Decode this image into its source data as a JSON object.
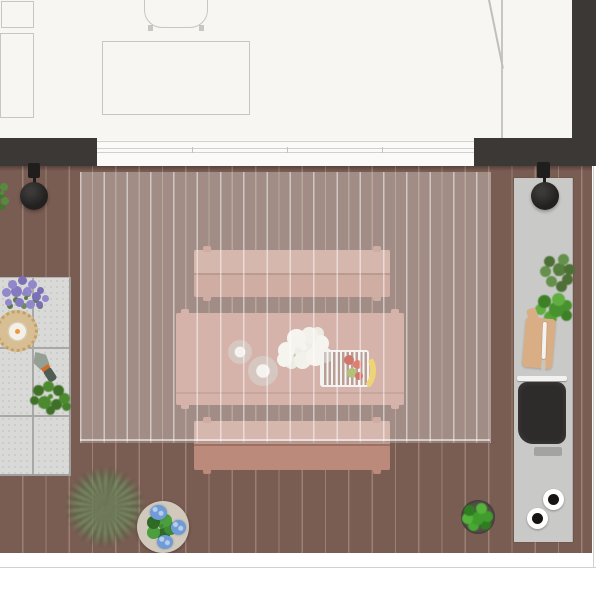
{
  "app": {
    "view": "top-down interior/terrace render",
    "visible_text": ""
  },
  "palette": {
    "wall_dark": "#3c3836",
    "interior_floor": "#f7f6f2",
    "outline": "#c9c6c1",
    "deck": "#795c52",
    "tile": "#d9d9d7",
    "counter": "#c9c9c7",
    "pink_bench": "#bc8a7b",
    "pink_table": "#c39386",
    "grill_dark": "#2e2c2a",
    "board_wood": "#d9ae85",
    "lavender": "#8d84c6",
    "banana": "#e7c23a",
    "apple_red": "#bf3b2c",
    "pear_green": "#93a843",
    "blue_flower": "#6f9bd6"
  },
  "labels": {
    "wardrobe": "wardrobe cabinet",
    "closet": "closet cabinet",
    "desk": "desk",
    "chair": "desk chair",
    "door": "entry door with open swing",
    "sliding_door": "sliding glass wall",
    "wall": "wall",
    "deck": "wood plank deck",
    "pergola": "pergola canopy",
    "lamp": "black pendant lamp",
    "bench": "outdoor bench",
    "table": "outdoor dining table",
    "bouquet": "white flower bouquet",
    "cup": "cup and saucer",
    "fruit_tray": "slatted tray with fruit",
    "patio_tiles": "tile patio",
    "lavender_plant": "lavender plant",
    "candle_tray": "rattan tray with candle",
    "trowel": "garden trowel",
    "herb": "leafy plant",
    "tree": "terrace tree",
    "flower_table": "side table with blue hydrangea",
    "potted_plant": "potted plant",
    "counter": "outdoor kitchen counter",
    "counter_plant": "potted herb",
    "cutting_board": "cutting board",
    "knife": "kitchen knife",
    "grill": "built-in grill",
    "knob": "burner knob"
  }
}
